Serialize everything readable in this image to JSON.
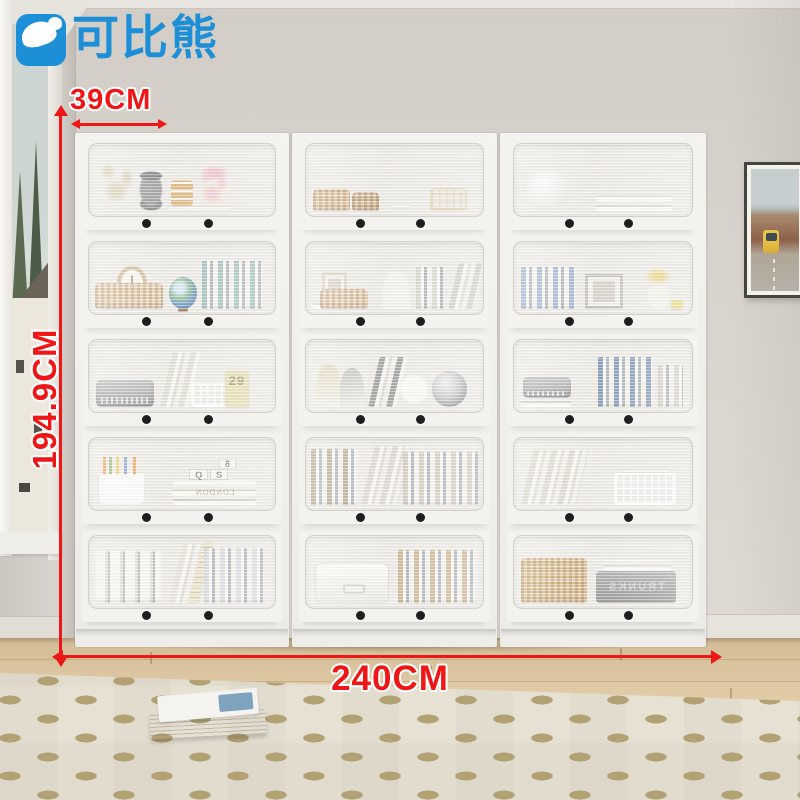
{
  "brand": {
    "name": "可比熊",
    "color": "#1d8fd7"
  },
  "annotations": {
    "depth_label": "39CM",
    "height_label": "194.9CM",
    "width_label": "240CM",
    "color": "#ee1616"
  },
  "colors": {
    "cabinet_white": "#f2f0ec",
    "wall": "#d8d3cc",
    "floor_wood": "#ddc8a4",
    "rug": "#e7e1d4",
    "knob": "#1e1e1e"
  },
  "cabinet": {
    "columns": 3,
    "rows": 5,
    "knobs_per_door": 2,
    "cells": {
      "u1r1": {
        "items": [
          {
            "t": "flowers",
            "x": 3,
            "w": 24,
            "h": 74,
            "c": "#cfc3a4"
          },
          {
            "t": "pebbles",
            "x": 27,
            "w": 13,
            "h": 56
          },
          {
            "t": "tray",
            "x": 41,
            "w": 36,
            "h": 7
          },
          {
            "t": "stack",
            "x": 44,
            "w": 12,
            "h": 36,
            "b": 7,
            "c": "#d9a96a"
          },
          {
            "t": "vase",
            "x": 61,
            "w": 13,
            "h": 32,
            "b": 7,
            "c": "#efe3d2",
            "c2": "#e8a7b8"
          },
          {
            "t": "flowers",
            "x": 57,
            "w": 20,
            "h": 64,
            "c": "#e9bcc8"
          }
        ]
      },
      "u1r2": {
        "items": [
          {
            "t": "hstack",
            "x": 4,
            "w": 22,
            "h": 12,
            "c": "#d8d2c6"
          },
          {
            "t": "clock",
            "x": 15,
            "w": 16,
            "h": 48,
            "b": 12,
            "c": "#c9ae85"
          },
          {
            "t": "basket",
            "x": 3,
            "w": 37,
            "h": 36,
            "c": "#d3b285"
          },
          {
            "t": "globe",
            "x": 43,
            "w": 15,
            "h": 44
          },
          {
            "t": "vbooks",
            "x": 61,
            "w": 33,
            "h": 66,
            "c": "#8fb3b0"
          }
        ]
      },
      "u1r3": {
        "items": [
          {
            "t": "radio",
            "x": 4,
            "w": 31,
            "h": 38
          },
          {
            "t": "lean",
            "x": 38,
            "w": 15,
            "h": 76,
            "c": "#dcd8ce"
          },
          {
            "t": "wirebasket",
            "x": 55,
            "w": 19,
            "h": 34,
            "c": "#ffffff"
          },
          {
            "t": "card",
            "x": 73,
            "w": 13,
            "h": 50,
            "c": "#ded5a0",
            "label": "29"
          }
        ]
      },
      "u1r4": {
        "items": [
          {
            "t": "pencup",
            "x": 5,
            "w": 25,
            "h": 46
          },
          {
            "t": "hstack",
            "x": 45,
            "w": 45,
            "h": 34,
            "c": "#cdc4b2",
            "label": "LONDON"
          },
          {
            "t": "cube",
            "x": 54,
            "w": 10,
            "h": 16,
            "b": 34,
            "label": "Q"
          },
          {
            "t": "cube",
            "x": 65,
            "w": 10,
            "h": 16,
            "b": 34,
            "label": "S"
          },
          {
            "t": "cube",
            "x": 70,
            "w": 9,
            "h": 14,
            "b": 50,
            "label": "8"
          }
        ]
      },
      "u1r5": {
        "items": [
          {
            "t": "binders",
            "x": 3,
            "w": 36,
            "h": 72
          },
          {
            "t": "lean",
            "x": 43,
            "w": 16,
            "h": 82,
            "c": "#e2ddd2"
          },
          {
            "t": "ruler",
            "x": 53,
            "w": 5,
            "h": 86
          },
          {
            "t": "vbooks",
            "x": 62,
            "w": 33,
            "h": 76,
            "c": "#cfd3d6"
          }
        ]
      },
      "u2r1": {
        "items": [
          {
            "t": "basket",
            "x": 4,
            "w": 21,
            "h": 30,
            "c": "#c8a06a"
          },
          {
            "t": "basket",
            "x": 26,
            "w": 15,
            "h": 26,
            "c": "#b98f5c"
          },
          {
            "t": "tray",
            "x": 47,
            "w": 13,
            "h": 6,
            "b": 4
          },
          {
            "t": "wirebasket",
            "x": 70,
            "w": 21,
            "h": 32,
            "c": "#d9c8a4"
          }
        ]
      },
      "u2r2": {
        "items": [
          {
            "t": "hstack",
            "x": 4,
            "w": 20,
            "h": 9,
            "c": "#d8d2c6"
          },
          {
            "t": "frame",
            "x": 9,
            "w": 14,
            "h": 42,
            "b": 9,
            "c": "#d6cab2"
          },
          {
            "t": "basket",
            "x": 8,
            "w": 27,
            "h": 28,
            "c": "#d3b285"
          },
          {
            "t": "figurine",
            "x": 43,
            "w": 16,
            "h": 52
          },
          {
            "t": "vbooks",
            "x": 62,
            "w": 16,
            "h": 58,
            "c": "#d2cfc8"
          },
          {
            "t": "lean",
            "x": 80,
            "w": 14,
            "h": 64,
            "c": "#c8c4bb"
          }
        ]
      },
      "u2r3": {
        "items": [
          {
            "t": "art",
            "x": 6,
            "w": 14,
            "h": 60,
            "c": "#d8c9a2"
          },
          {
            "t": "art",
            "x": 19,
            "w": 14,
            "h": 54,
            "c": "#a9a5a0"
          },
          {
            "t": "lean",
            "x": 35,
            "w": 16,
            "h": 70,
            "c": "#8f8f8d"
          },
          {
            "t": "plate",
            "x": 53,
            "w": 16,
            "h": 50
          },
          {
            "t": "sphere",
            "x": 71,
            "w": 20,
            "h": 50,
            "c": "#9aa0a4"
          }
        ]
      },
      "u2r4": {
        "items": [
          {
            "t": "vbooks",
            "x": 3,
            "w": 27,
            "h": 78,
            "c": "#a99a82"
          },
          {
            "t": "lean",
            "x": 31,
            "w": 21,
            "h": 82,
            "c": "#d6d1c8"
          },
          {
            "t": "vbooks",
            "x": 55,
            "w": 42,
            "h": 74,
            "c": "#c9c2b4"
          }
        ]
      },
      "u2r5": {
        "items": [
          {
            "t": "box",
            "x": 5,
            "w": 42,
            "h": 56
          },
          {
            "t": "vbooks",
            "x": 52,
            "w": 45,
            "h": 74,
            "c": "#c2a87e"
          }
        ]
      },
      "u3r1": {
        "items": [
          {
            "t": "lamp",
            "x": 7,
            "w": 24,
            "h": 56
          },
          {
            "t": "hstack",
            "x": 46,
            "w": 43,
            "h": 22,
            "c": "#d9d3c7"
          }
        ]
      },
      "u3r2": {
        "items": [
          {
            "t": "vbooks",
            "x": 4,
            "w": 30,
            "h": 58,
            "c": "#8fa6c8"
          },
          {
            "t": "frame",
            "x": 40,
            "w": 21,
            "h": 48,
            "c": "#b9b5ae"
          },
          {
            "t": "vase",
            "x": 75,
            "w": 12,
            "h": 32,
            "c": "#f2efe8",
            "c2": "#e3c74e"
          },
          {
            "t": "card",
            "x": 88,
            "w": 7,
            "h": 12,
            "c": "#e4d46e"
          }
        ]
      },
      "u3r3": {
        "items": [
          {
            "t": "hstack",
            "x": 4,
            "w": 28,
            "h": 12,
            "c": "#cfc9be"
          },
          {
            "t": "radio",
            "x": 5,
            "w": 27,
            "h": 30,
            "b": 12
          },
          {
            "t": "vbooks",
            "x": 47,
            "w": 31,
            "h": 70,
            "c": "#6c87a8"
          },
          {
            "t": "vbooks",
            "x": 81,
            "w": 14,
            "h": 58,
            "c": "#cfc9c0"
          }
        ]
      },
      "u3r4": {
        "items": [
          {
            "t": "lean",
            "x": 4,
            "w": 31,
            "h": 76,
            "c": "#d6d0c4"
          },
          {
            "t": "wirebasket",
            "x": 56,
            "w": 35,
            "h": 44,
            "c": "#ffffff"
          },
          {
            "t": "tray",
            "x": 60,
            "w": 27,
            "h": 6,
            "b": 44
          }
        ]
      },
      "u3r5": {
        "items": [
          {
            "t": "basket",
            "x": 4,
            "w": 37,
            "h": 62,
            "c": "#c59a57"
          },
          {
            "t": "trunk",
            "x": 46,
            "w": 45,
            "h": 44,
            "label": "TRUNKS"
          },
          {
            "t": "hstack",
            "x": 50,
            "w": 38,
            "h": 16,
            "b": 44,
            "c": "#d8d2c6"
          }
        ]
      }
    }
  }
}
